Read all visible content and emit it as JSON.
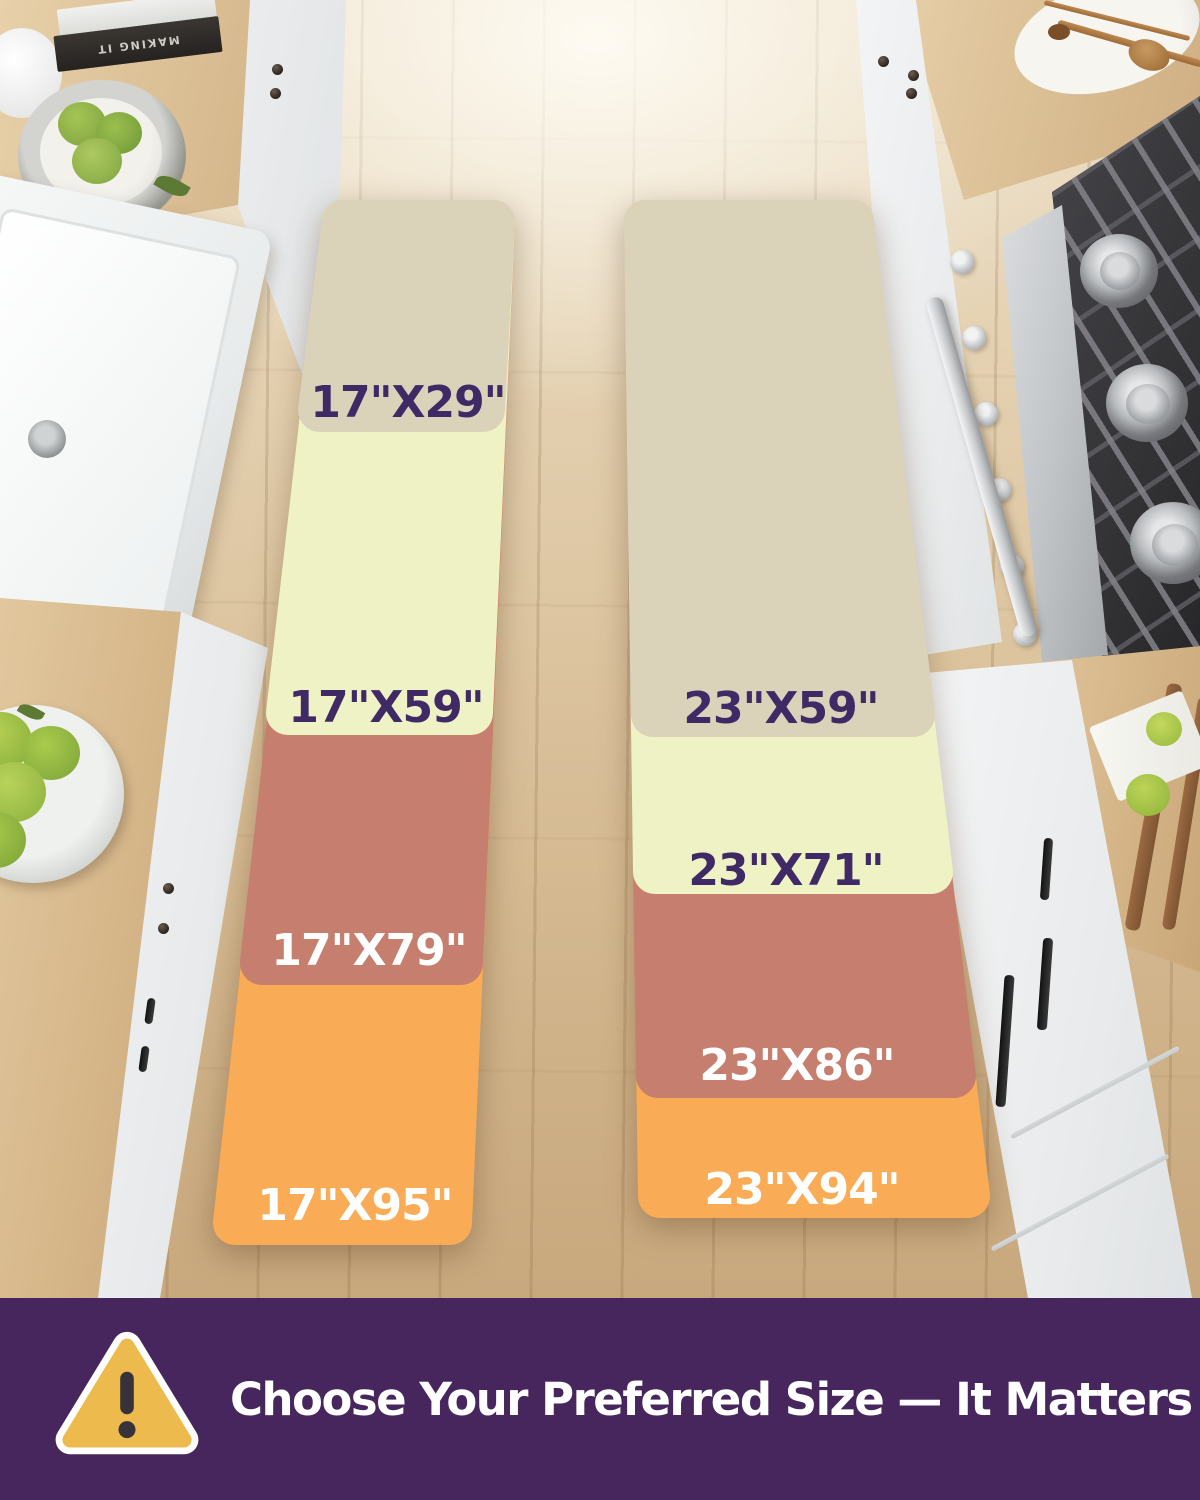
{
  "runners": {
    "left": {
      "sizes": [
        {
          "label": "17\"X29\"",
          "color": "#dbd2ba",
          "label_color": "#402a66"
        },
        {
          "label": "17\"X59\"",
          "color": "#eff2c5",
          "label_color": "#402a66"
        },
        {
          "label": "17\"X79\"",
          "color": "#c67e6f",
          "label_color": "#ffffff"
        },
        {
          "label": "17\"X95\"",
          "color": "#f9ac55",
          "label_color": "#ffffff"
        }
      ]
    },
    "right": {
      "sizes": [
        {
          "label": "23\"X59\"",
          "color": "#dbd2ba",
          "label_color": "#402a66"
        },
        {
          "label": "23\"X71\"",
          "color": "#eff2c5",
          "label_color": "#402a66"
        },
        {
          "label": "23\"X86\"",
          "color": "#c67e6f",
          "label_color": "#ffffff"
        },
        {
          "label": "23\"X94\"",
          "color": "#f9ac55",
          "label_color": "#ffffff"
        }
      ]
    }
  },
  "banner": {
    "text": "Choose Your Preferred Size — It Matters",
    "background": "#46265c",
    "text_color": "#ffffff",
    "icon": {
      "name": "warning-triangle-icon",
      "fill": "#edba4d",
      "outline": "#ffffff",
      "mark_color": "#38323a"
    }
  },
  "decor": {
    "book_spine_text": "MAKING IT"
  }
}
